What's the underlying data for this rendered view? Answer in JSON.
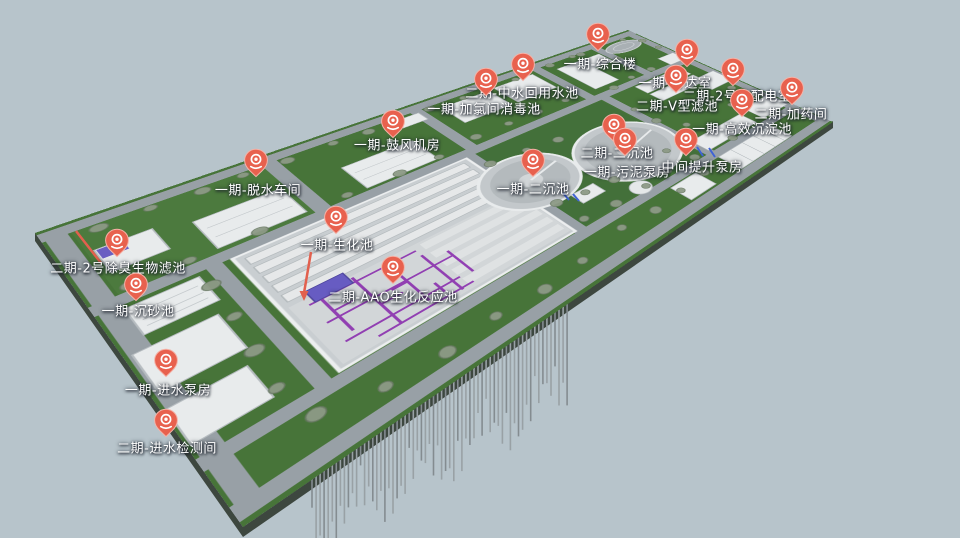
{
  "scene": {
    "background_color": "#b7c4cb",
    "terrain_color": "#477439",
    "road_color": "#98a0a6",
    "building_color": "#e8ebec",
    "pin_color": "#e8614e",
    "pipe_color": "#8a2fae",
    "highlight_color": "#675cc2",
    "annotation_color": "#e2604e"
  },
  "markers": [
    {
      "id": "comprehensive-building",
      "label": "一期-综合楼",
      "pin": {
        "x": 598,
        "y": 40
      },
      "text": {
        "x": 600,
        "y": 63
      }
    },
    {
      "id": "reclaimed-water-pool",
      "label": "二期-中水回用水池",
      "pin": {
        "x": 523,
        "y": 70
      },
      "text": {
        "x": 522,
        "y": 92
      }
    },
    {
      "id": "gatehouse",
      "label": "一期-传达室",
      "pin": {
        "x": 687,
        "y": 56
      },
      "text": {
        "x": 675,
        "y": 82
      }
    },
    {
      "id": "chlorination-disinfection-pool",
      "label": "一期-加氯间消毒池",
      "pin": {
        "x": 486,
        "y": 85
      },
      "text": {
        "x": 484,
        "y": 108
      }
    },
    {
      "id": "no2-power-distribution-room",
      "label": "二期-2号变配电室",
      "pin": {
        "x": 733,
        "y": 75
      },
      "text": {
        "x": 737,
        "y": 95
      }
    },
    {
      "id": "v-type-filter",
      "label": "二期-V型滤池",
      "pin": {
        "x": 676,
        "y": 82
      },
      "text": {
        "x": 677,
        "y": 105
      }
    },
    {
      "id": "dosing-room",
      "label": "二期-加药间",
      "pin": {
        "x": 792,
        "y": 94
      },
      "text": {
        "x": 791,
        "y": 113
      }
    },
    {
      "id": "high-efficiency-sedimentation",
      "label": "一期-高效沉淀池",
      "pin": {
        "x": 742,
        "y": 106
      },
      "text": {
        "x": 742,
        "y": 128
      }
    },
    {
      "id": "blower-room",
      "label": "一期-鼓风机房",
      "pin": {
        "x": 393,
        "y": 127
      },
      "text": {
        "x": 397,
        "y": 144
      }
    },
    {
      "id": "phase2-secondary-sedimentation",
      "label": "二期-二沉池",
      "pin": {
        "x": 614,
        "y": 131
      },
      "text": {
        "x": 617,
        "y": 152
      }
    },
    {
      "id": "sludge-pump-room",
      "label": "一期-污泥泵房",
      "pin": {
        "x": 625,
        "y": 145
      },
      "text": {
        "x": 627,
        "y": 171
      }
    },
    {
      "id": "intermediate-lift-pump-room",
      "label": "中间提升泵房",
      "pin": {
        "x": 686,
        "y": 145
      },
      "text": {
        "x": 702,
        "y": 166
      }
    },
    {
      "id": "phase1-secondary-sedimentation",
      "label": "一期-二沉池",
      "pin": {
        "x": 533,
        "y": 166
      },
      "text": {
        "x": 533,
        "y": 188
      }
    },
    {
      "id": "dewatering-workshop",
      "label": "一期-脱水车间",
      "pin": {
        "x": 256,
        "y": 166
      },
      "text": {
        "x": 258,
        "y": 189
      }
    },
    {
      "id": "biochemical-pool",
      "label": "一期-生化池",
      "pin": {
        "x": 336,
        "y": 223
      },
      "text": {
        "x": 337,
        "y": 244
      }
    },
    {
      "id": "aao-bioreactor",
      "label": "二期-AAO生化反应池",
      "pin": {
        "x": 393,
        "y": 273
      },
      "text": {
        "x": 393,
        "y": 296
      }
    },
    {
      "id": "no2-deodorization-biofilter",
      "label": "二期-2号除臭生物滤池",
      "pin": {
        "x": 117,
        "y": 246
      },
      "text": {
        "x": 118,
        "y": 267
      }
    },
    {
      "id": "grit-chamber",
      "label": "一期-沉砂池",
      "pin": {
        "x": 136,
        "y": 290
      },
      "text": {
        "x": 138,
        "y": 310
      }
    },
    {
      "id": "inlet-pump-room",
      "label": "一期-进水泵房",
      "pin": {
        "x": 166,
        "y": 366
      },
      "text": {
        "x": 168,
        "y": 389
      }
    },
    {
      "id": "inlet-monitoring-room",
      "label": "二期-进水检测间",
      "pin": {
        "x": 166,
        "y": 426
      },
      "text": {
        "x": 167,
        "y": 447
      }
    }
  ]
}
